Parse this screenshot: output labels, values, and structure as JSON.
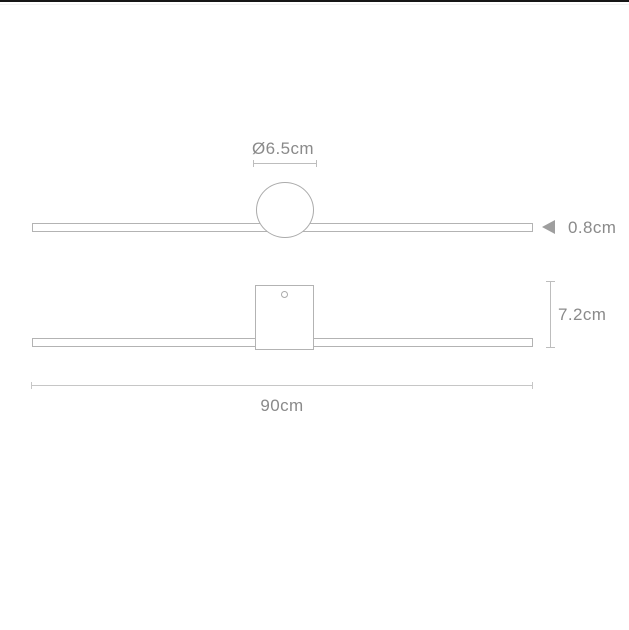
{
  "labels": {
    "diameter": "Ø6.5cm",
    "thickness": "0.8cm",
    "height": "7.2cm",
    "length": "90cm"
  },
  "colors": {
    "background": "#ffffff",
    "outline": "#b3b3b3",
    "dimension_line": "#bdbdbd",
    "text": "#8a8a8a",
    "arrow": "#9e9e9e",
    "top_edge": "#161616"
  }
}
